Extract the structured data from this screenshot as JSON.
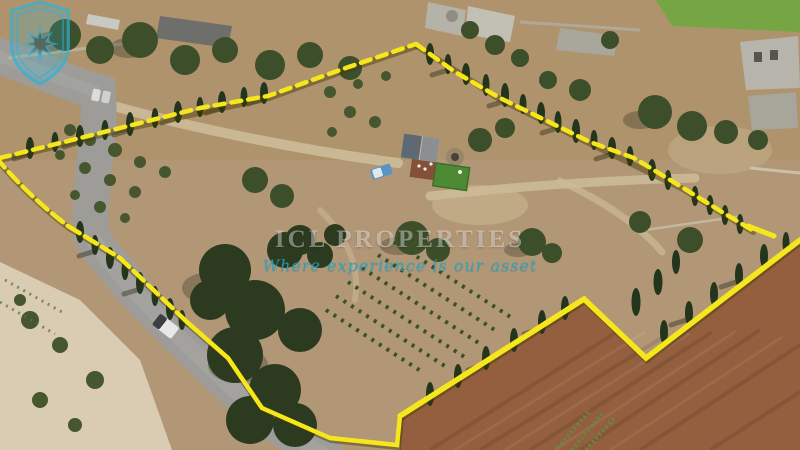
{
  "image_type": "aerial-3d-property-listing-photo",
  "watermark": {
    "brand": "ICL PROPERTIES",
    "tagline": "Where experience is our asset",
    "logo_icon": "shield-star-badge",
    "accent_color": "#2fb3d6",
    "brand_text_color": "rgba(255,255,255,0.40)"
  },
  "scene": {
    "boundary_color": "#f6e71c",
    "boundary_style": "yellow property demarcation line",
    "road_color": "#9d9c98",
    "ploughed_field_color": "#935f3e",
    "terrain_color": "#b29776",
    "lawn_color": "#4d8a33",
    "features": [
      "asphalt country road with white pickup truck",
      "two parked cars at top-left",
      "farmhouse with solar-panel roof",
      "round corbelled stone hut",
      "green lawn and terracotta patio",
      "blue van near farmhouse",
      "cypress tree rows along boundary",
      "vineyard rows in plot centre",
      "large ploughed brown field bottom-right",
      "stone rubble walls",
      "green field top-right corner",
      "stone buildings and ruins along the top"
    ]
  }
}
